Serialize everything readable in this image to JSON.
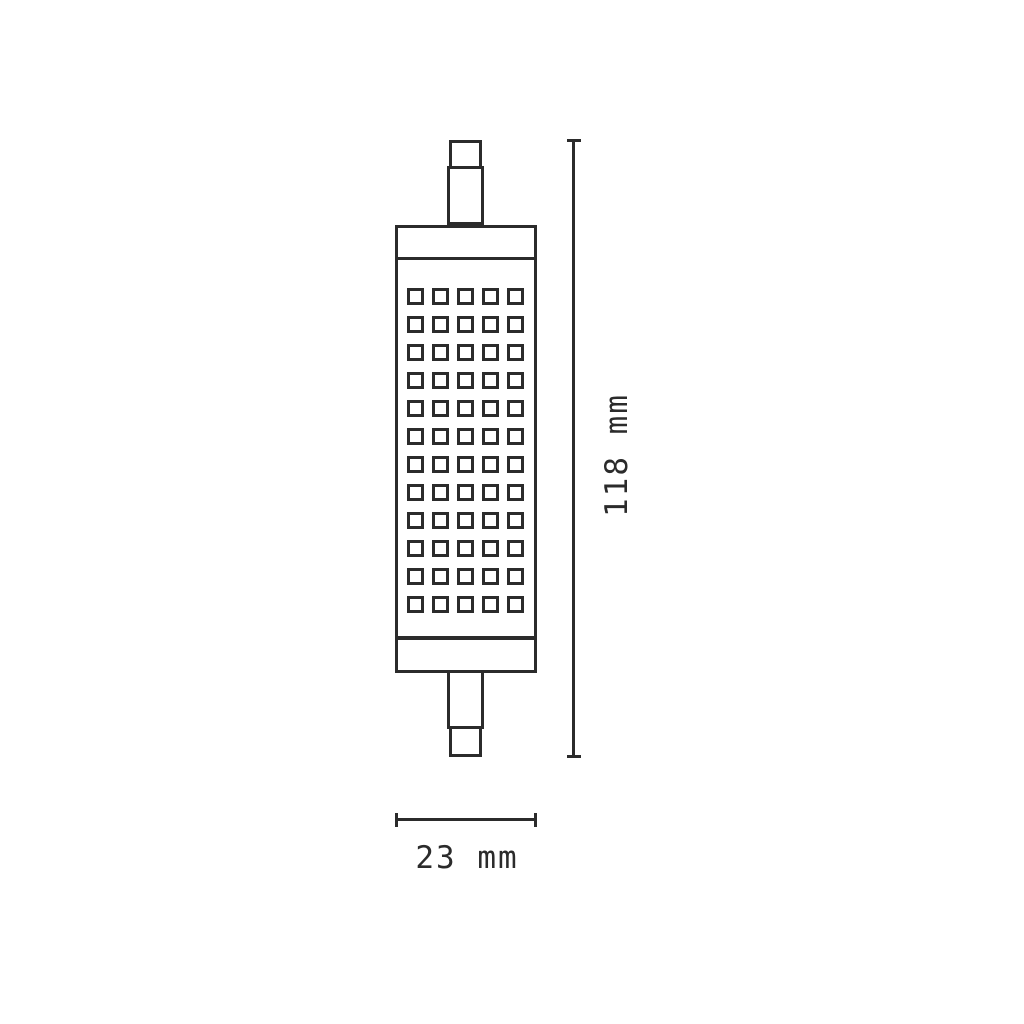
{
  "diagram": {
    "title": "lamp-dimension-diagram"
  },
  "dimensions": {
    "height": {
      "label": "118 mm"
    },
    "width": {
      "label": "23 mm"
    }
  },
  "lamp": {
    "led_grid": {
      "rows": 12,
      "columns": 5
    }
  },
  "colors": {
    "stroke": "#2b2b2b",
    "background": "#ffffff"
  }
}
